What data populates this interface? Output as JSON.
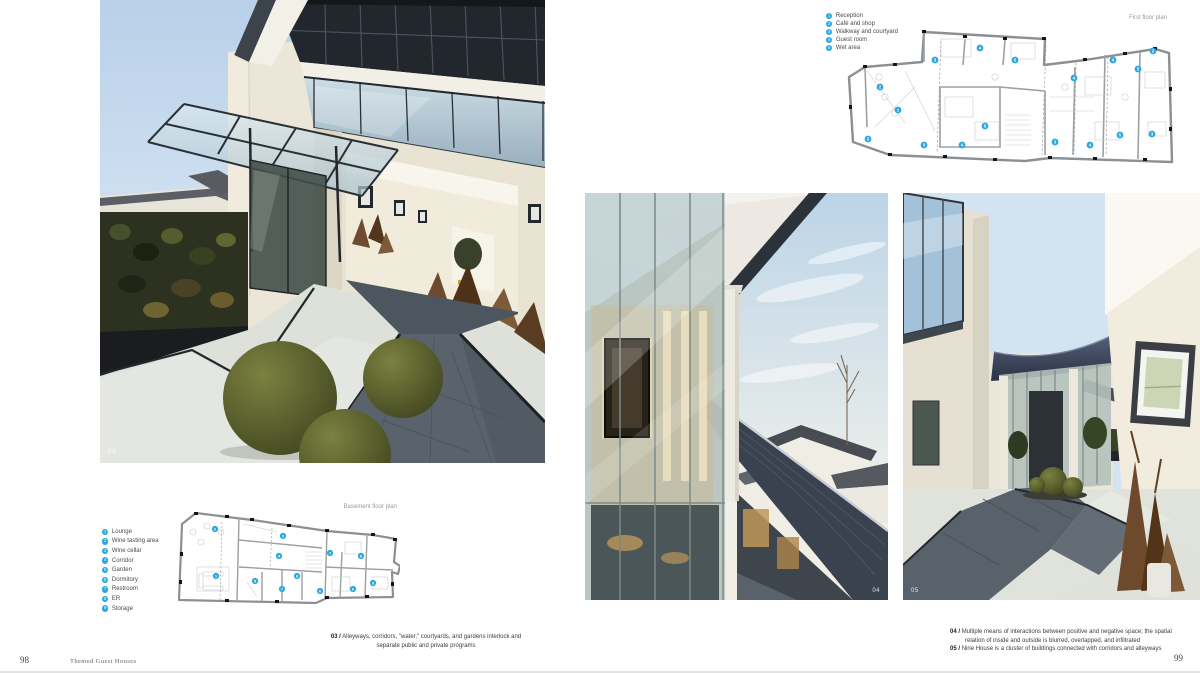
{
  "page": {
    "left_number": "98",
    "right_number": "99",
    "book_title": "Themed Guest Houses"
  },
  "photos": {
    "photo03": {
      "label": "03"
    },
    "photo04": {
      "label": "04"
    },
    "photo05": {
      "label": "05"
    }
  },
  "captions": {
    "c03": {
      "num": "03 /",
      "text": "Alleyways, corridors, \"water,\" courtyards, and gardens interlock and separate public and private programs"
    },
    "c04": {
      "num": "04 /",
      "text": "Multiple means of interactions between positive and negative space; the spatial relation of inside and outside is blurred, overlapped, and infiltrated"
    },
    "c05": {
      "num": "05 /",
      "text": "Nine House is a cluster of buildings connected with corridors and alleyways"
    }
  },
  "plans": {
    "first_floor": {
      "title": "First floor plan",
      "legend": [
        {
          "num": "1",
          "label": "Reception"
        },
        {
          "num": "2",
          "label": "Café and shop"
        },
        {
          "num": "3",
          "label": "Walkway and courtyard"
        },
        {
          "num": "4",
          "label": "Guest room"
        },
        {
          "num": "5",
          "label": "Wet area"
        }
      ],
      "markers": [
        {
          "n": "3",
          "x": 90,
          "y": 33
        },
        {
          "n": "4",
          "x": 135,
          "y": 21
        },
        {
          "n": "5",
          "x": 170,
          "y": 33
        },
        {
          "n": "2",
          "x": 35,
          "y": 60
        },
        {
          "n": "1",
          "x": 53,
          "y": 83
        },
        {
          "n": "3",
          "x": 23,
          "y": 112
        },
        {
          "n": "3",
          "x": 79,
          "y": 118
        },
        {
          "n": "4",
          "x": 117,
          "y": 118
        },
        {
          "n": "5",
          "x": 140,
          "y": 99
        },
        {
          "n": "3",
          "x": 210,
          "y": 115
        },
        {
          "n": "4",
          "x": 229,
          "y": 51
        },
        {
          "n": "4",
          "x": 245,
          "y": 118
        },
        {
          "n": "4",
          "x": 268,
          "y": 33
        },
        {
          "n": "5",
          "x": 275,
          "y": 108
        },
        {
          "n": "5",
          "x": 293,
          "y": 42
        },
        {
          "n": "2",
          "x": 308,
          "y": 24
        },
        {
          "n": "3",
          "x": 307,
          "y": 107
        }
      ]
    },
    "basement": {
      "title": "Basement floor plan",
      "legend": [
        {
          "num": "1",
          "label": "Lounge"
        },
        {
          "num": "2",
          "label": "Wine tasting area"
        },
        {
          "num": "3",
          "label": "Wine cellar"
        },
        {
          "num": "4",
          "label": "Corridor"
        },
        {
          "num": "5",
          "label": "Garden"
        },
        {
          "num": "6",
          "label": "Dormitory"
        },
        {
          "num": "7",
          "label": "Restroom"
        },
        {
          "num": "8",
          "label": "ER"
        },
        {
          "num": "9",
          "label": "Storage"
        }
      ],
      "markers": [
        {
          "n": "2",
          "x": 38,
          "y": 17
        },
        {
          "n": "3",
          "x": 106,
          "y": 24
        },
        {
          "n": "1",
          "x": 39,
          "y": 64
        },
        {
          "n": "4",
          "x": 102,
          "y": 44
        },
        {
          "n": "5",
          "x": 78,
          "y": 69
        },
        {
          "n": "7",
          "x": 105,
          "y": 77
        },
        {
          "n": "8",
          "x": 120,
          "y": 64
        },
        {
          "n": "6",
          "x": 143,
          "y": 79
        },
        {
          "n": "7",
          "x": 153,
          "y": 41
        },
        {
          "n": "6",
          "x": 184,
          "y": 44
        },
        {
          "n": "6",
          "x": 176,
          "y": 77
        },
        {
          "n": "9",
          "x": 196,
          "y": 71
        }
      ]
    }
  },
  "colors": {
    "accent_blue": "#2aa7df",
    "plan_gray": "#8b9094"
  }
}
